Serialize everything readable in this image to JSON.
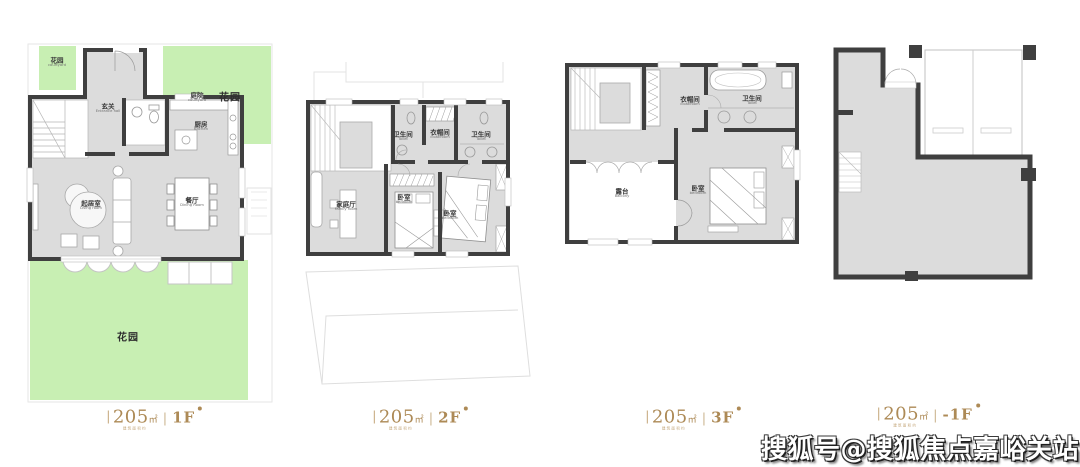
{
  "watermark": {
    "text": "搜狐号@搜狐焦点嘉峪关站"
  },
  "colors": {
    "garden_green": "#c8efb3",
    "floor_gray": "#dcdcdc",
    "wall_dark": "#3f3f3f",
    "label_gold": "#ad8a56",
    "watermark_fill": "#ffffff",
    "watermark_outline": "#1f1f1f"
  },
  "plans": [
    {
      "name": "first-floor",
      "label": {
        "note": "建筑面积约",
        "area": "205",
        "unit": "㎡",
        "divider": "|",
        "floor": "1F"
      },
      "rooms": {
        "garden_small": {
          "zh": "花园",
          "en": "courtyard"
        },
        "garden_right_note": {
          "zh": "庭院",
          "en": "courtyard"
        },
        "garden_right": {
          "zh": "花园"
        },
        "entrance": {
          "zh": "玄关",
          "en": "Entrance hall"
        },
        "kitchen": {
          "zh": "厨房",
          "en": "Kitchen"
        },
        "living": {
          "zh": "起居室",
          "en": "Living room"
        },
        "dining": {
          "zh": "餐厅",
          "en": "Dining Room"
        },
        "garden_bottom": {
          "zh": "花园"
        }
      }
    },
    {
      "name": "second-floor",
      "label": {
        "note": "建筑面积约",
        "area": "205",
        "unit": "㎡",
        "divider": "|",
        "floor": "2F"
      },
      "rooms": {
        "toilet_left": {
          "zh": "卫生间",
          "en": "Toilet"
        },
        "cloakroom": {
          "zh": "衣帽间",
          "en": "cloakroom"
        },
        "toilet_right": {
          "zh": "卫生间",
          "en": "Toilet"
        },
        "family_room": {
          "zh": "家庭厅",
          "en": "Family room"
        },
        "bedroom_mid": {
          "zh": "卧室",
          "en": "bedroom"
        },
        "bedroom_right": {
          "zh": "卧室",
          "en": "bedroom"
        }
      }
    },
    {
      "name": "third-floor",
      "label": {
        "note": "建筑面积约",
        "area": "205",
        "unit": "㎡",
        "divider": "|",
        "floor": "3F"
      },
      "rooms": {
        "cloakroom": {
          "zh": "衣帽间",
          "en": "cloakroom"
        },
        "toilet": {
          "zh": "卫生间",
          "en": "Toilet"
        },
        "balcony": {
          "zh": "露台",
          "en": "balcony"
        },
        "bedroom": {
          "zh": "卧室",
          "en": "bedroom"
        }
      }
    },
    {
      "name": "basement",
      "label": {
        "note": "建筑面积约",
        "area": "205",
        "unit": "㎡",
        "divider": "|",
        "floor": "-1F"
      }
    }
  ]
}
